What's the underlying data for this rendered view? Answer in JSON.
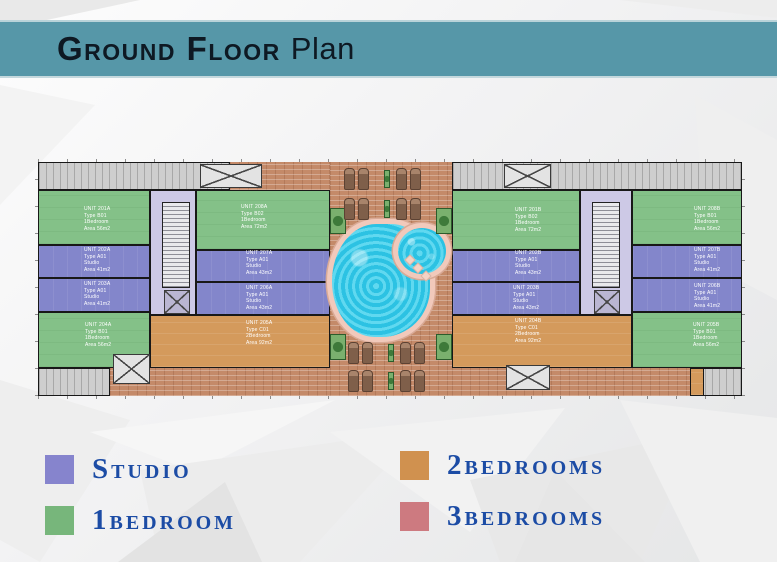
{
  "header": {
    "title_main": "Ground Floor",
    "title_suffix": "Plan",
    "bar_color": "#5697a8",
    "title_color": "#0e1923"
  },
  "legend": {
    "text_color": "#1c4ca5",
    "items": [
      {
        "label": "Studio",
        "color": "#8684cd"
      },
      {
        "label": "1bedroom",
        "color": "#77b67b"
      },
      {
        "label": "2bedrooms",
        "color": "#d0914f"
      },
      {
        "label": "3bedrooms",
        "color": "#cd7a80"
      }
    ]
  },
  "plan": {
    "colors": {
      "studio_fill": "#8386cb",
      "one_bedroom_fill": "#84c188",
      "two_bedroom_fill": "#d49a5c",
      "core_fill": "#cdc9e6",
      "terrace_brick": "#c48a69",
      "parking_gray": "#cecece",
      "pool_water": "#38cfec",
      "pool_rim": "#f1c9bb"
    },
    "units": [
      {
        "id": "201A",
        "label": "UNIT 201A\nType B01\n1Bedroom\nArea 56m2"
      },
      {
        "id": "202A",
        "label": "UNIT 202A\nType A01\nStudio\nArea 41m2"
      },
      {
        "id": "203A",
        "label": "UNIT 203A\nType A01\nStudio\nArea 41m2"
      },
      {
        "id": "204A",
        "label": "UNIT 204A\nType B01\n1Bedroom\nArea 56m2"
      },
      {
        "id": "208A",
        "label": "UNIT 208A\nType B02\n1Bedroom\nArea 72m2"
      },
      {
        "id": "207A",
        "label": "UNIT 207A\nType A01\nStudio\nArea 43m2"
      },
      {
        "id": "206A",
        "label": "UNIT 206A\nType A01\nStudio\nArea 43m2"
      },
      {
        "id": "205A",
        "label": "UNIT 205A\nType C01\n2Bedroom\nArea 92m2"
      },
      {
        "id": "201B",
        "label": "UNIT 201B\nType B02\n1Bedroom\nArea 72m2"
      },
      {
        "id": "202B",
        "label": "UNIT 202B\nType A01\nStudio\nArea 43m2"
      },
      {
        "id": "203B",
        "label": "UNIT 203B\nType A01\nStudio\nArea 43m2"
      },
      {
        "id": "204B",
        "label": "UNIT 204B\nType C01\n2Bedroom\nArea 92m2"
      },
      {
        "id": "208B",
        "label": "UNIT 208B\nType B01\n1Bedroom\nArea 56m2"
      },
      {
        "id": "207B",
        "label": "UNIT 207B\nType A01\nStudio\nArea 41m2"
      },
      {
        "id": "206B",
        "label": "UNIT 206B\nType A01\nStudio\nArea 41m2"
      },
      {
        "id": "205B",
        "label": "UNIT 205B\nType B01\n1Bedroom\nArea 56m2"
      }
    ]
  }
}
